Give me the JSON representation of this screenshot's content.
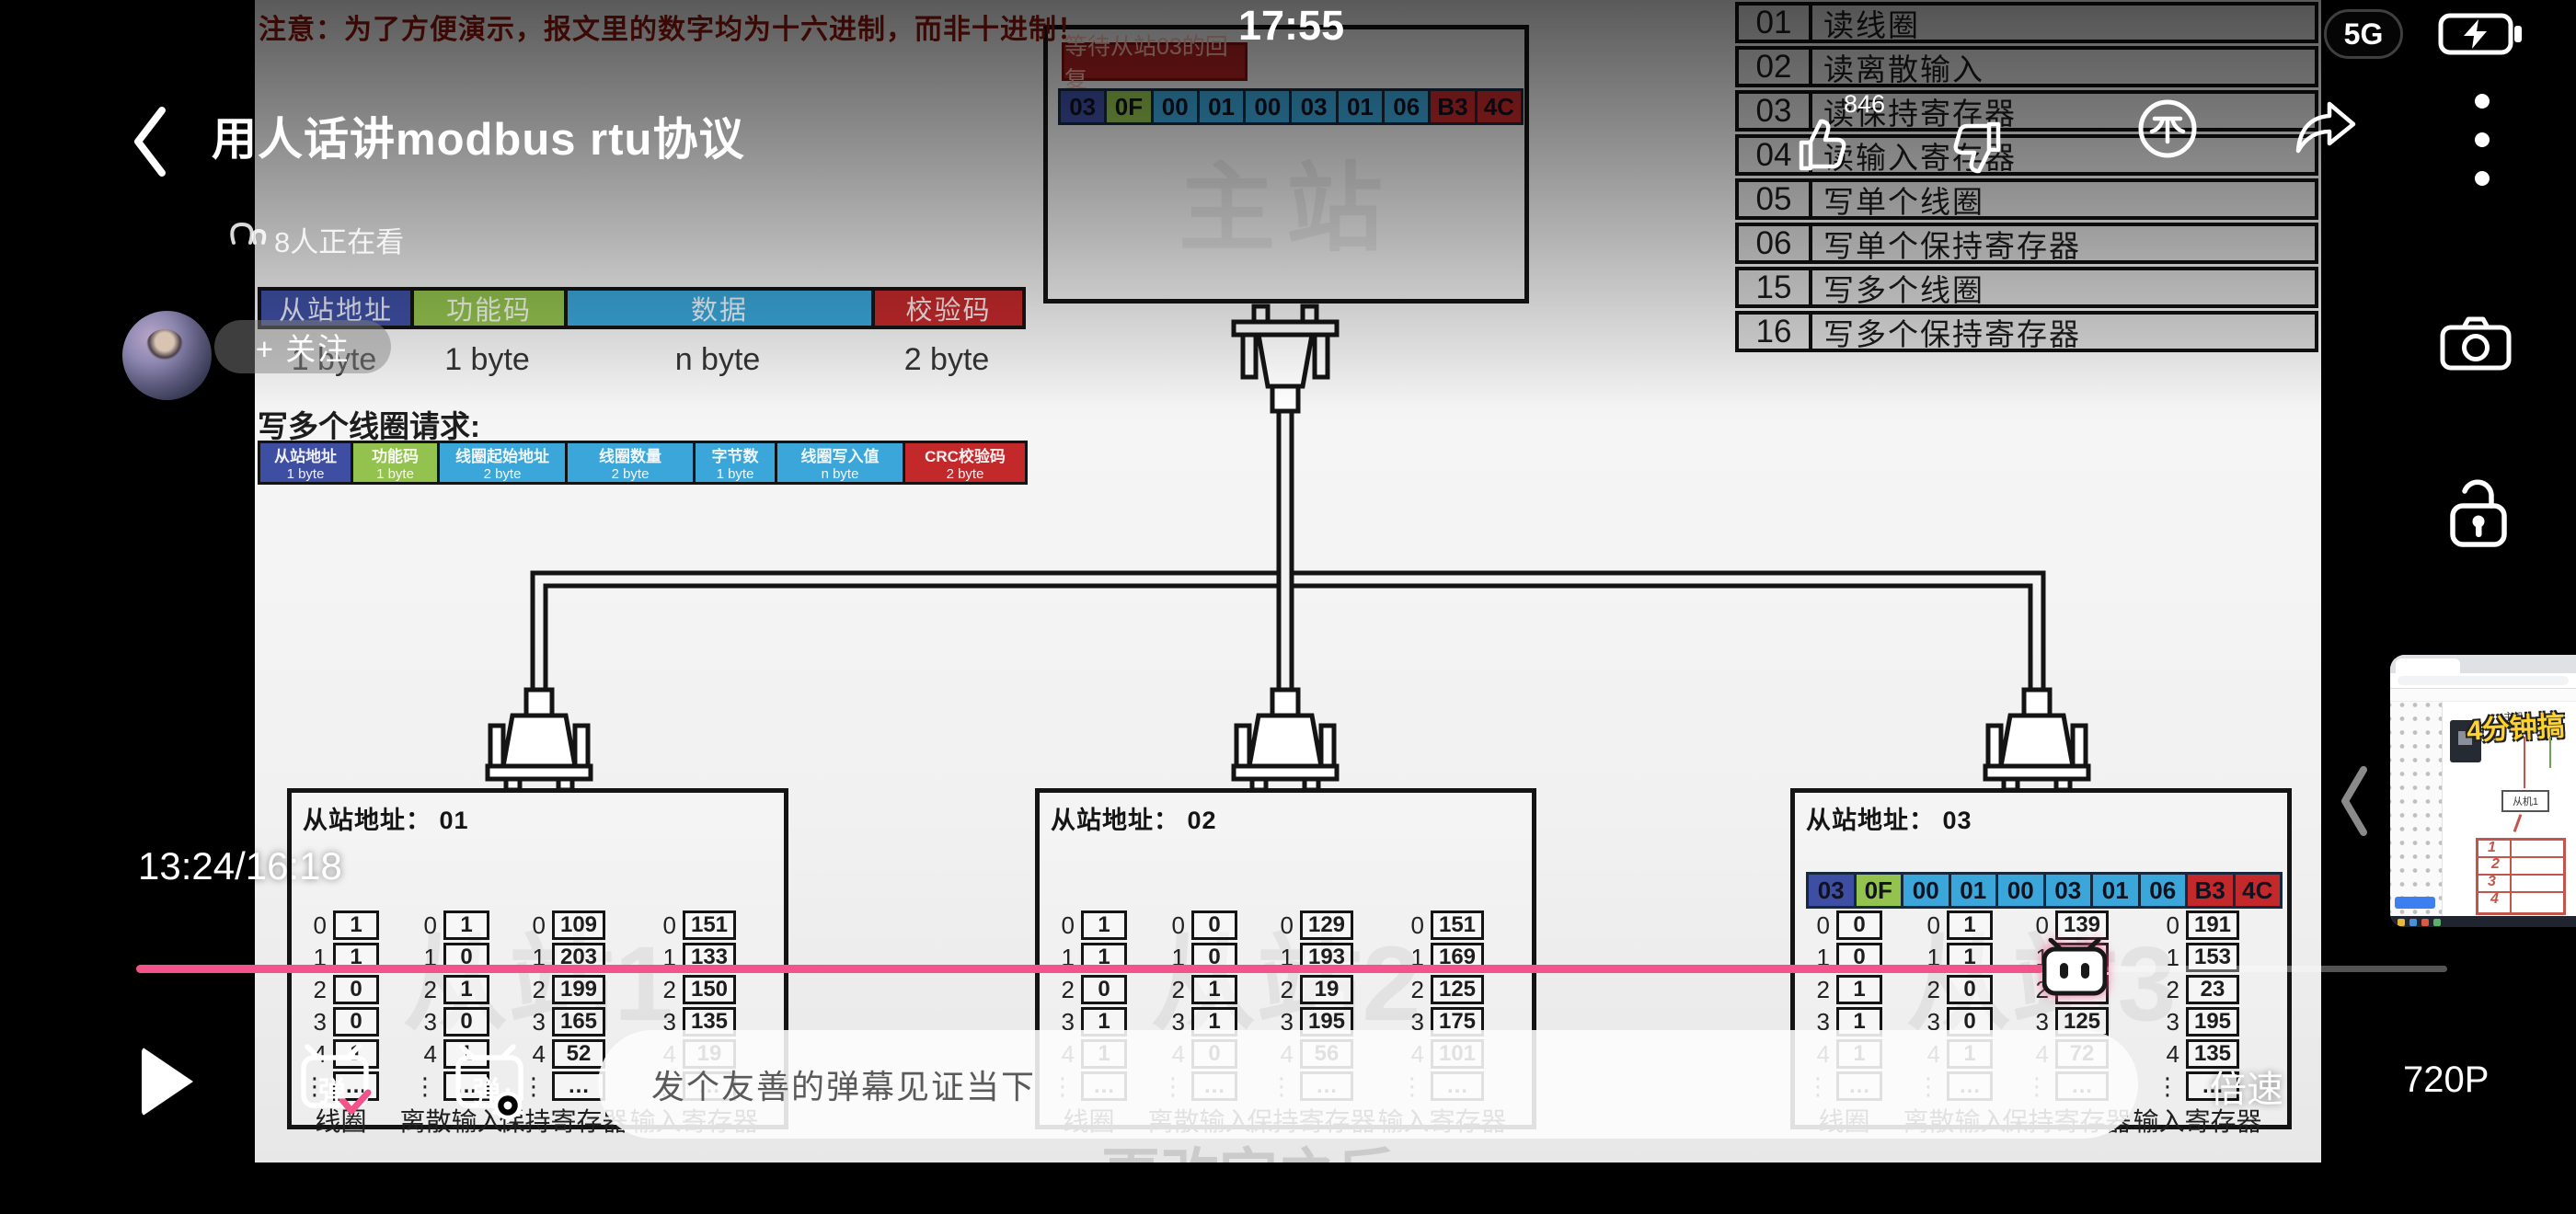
{
  "status_bar": {
    "time": "17:55",
    "network": "5G"
  },
  "player": {
    "title": "用人话讲modbus rtu协议",
    "viewers": "8人正在看",
    "follow_label": "+ 关注",
    "like_count": "846",
    "progress": {
      "display": "13:24/16:18",
      "current": "13:24",
      "duration": "16:18",
      "percent": 82
    },
    "danmaku_char": "弹",
    "danmaku_placeholder": "发个友善的弹幕见证当下",
    "speed_label": "倍速",
    "quality_label": "720P"
  },
  "colors": {
    "accent_pink": "#f2538b",
    "byte_address": "#3e4fa3",
    "byte_function": "#93c24e",
    "byte_data": "#3aa6d9",
    "byte_crc": "#c3292b",
    "warning_red": "#8a150c"
  },
  "video": {
    "warning": "注意：为了方便演示，报文里的数字均为十六进制，而非十进制！",
    "row_indices": [
      "0",
      "1",
      "2",
      "3",
      "4",
      "⋮"
    ],
    "master": {
      "watermark": "主站",
      "status_label": "等待从站03的回复",
      "message": [
        "03",
        "0F",
        "00",
        "01",
        "00",
        "03",
        "01",
        "06",
        "B3",
        "4C"
      ]
    },
    "frame_fields": [
      {
        "label": "从站地址",
        "size": "1 byte",
        "type": "addr"
      },
      {
        "label": "功能码",
        "size": "1 byte",
        "type": "func"
      },
      {
        "label": "数据",
        "size": "n byte",
        "type": "data"
      },
      {
        "label": "校验码",
        "size": "2 byte",
        "type": "crc"
      }
    ],
    "request_title": "写多个线圈请求:",
    "request_fields": [
      {
        "label": "从站地址",
        "size": "1 byte",
        "type": "addr"
      },
      {
        "label": "功能码",
        "size": "1 byte",
        "type": "func"
      },
      {
        "label": "线圈起始地址",
        "size": "2 byte",
        "type": "data"
      },
      {
        "label": "线圈数量",
        "size": "2 byte",
        "type": "data"
      },
      {
        "label": "字节数",
        "size": "1 byte",
        "type": "data"
      },
      {
        "label": "线圈写入值",
        "size": "n byte",
        "type": "data"
      },
      {
        "label": "CRC校验码",
        "size": "2 byte",
        "type": "crc"
      }
    ],
    "function_table": [
      {
        "code": "01",
        "name": "读线圈"
      },
      {
        "code": "02",
        "name": "读离散输入"
      },
      {
        "code": "03",
        "name": "读保持寄存器"
      },
      {
        "code": "04",
        "name": "读输入寄存器"
      },
      {
        "code": "05",
        "name": "写单个线圈"
      },
      {
        "code": "06",
        "name": "写单个保持寄存器"
      },
      {
        "code": "15",
        "name": "写多个线圈"
      },
      {
        "code": "16",
        "name": "写多个保持寄存器"
      }
    ],
    "slaves": [
      {
        "title": "从站地址： 01",
        "watermark": "从站1",
        "labels": [
          "线圈",
          "离散输入",
          "保持寄存器",
          "输入寄存器"
        ],
        "coils": [
          "1",
          "1",
          "0",
          "0",
          "1",
          "…"
        ],
        "discrete": [
          "1",
          "0",
          "1",
          "0",
          "1",
          "…"
        ],
        "holding": [
          "109",
          "203",
          "199",
          "165",
          "52",
          "…"
        ],
        "input": [
          "151",
          "133",
          "150",
          "135",
          "19",
          "…"
        ]
      },
      {
        "title": "从站地址： 02",
        "watermark": "从站2",
        "labels": [
          "线圈",
          "离散输入",
          "保持寄存器",
          "输入寄存器"
        ],
        "coils": [
          "1",
          "1",
          "0",
          "1",
          "1",
          "…"
        ],
        "discrete": [
          "0",
          "0",
          "1",
          "1",
          "0",
          "…"
        ],
        "holding": [
          "129",
          "193",
          "19",
          "195",
          "56",
          "…"
        ],
        "input": [
          "151",
          "169",
          "125",
          "175",
          "101",
          "…"
        ]
      },
      {
        "title": "从站地址： 03",
        "watermark": "从站3",
        "message": [
          "03",
          "0F",
          "00",
          "01",
          "00",
          "03",
          "01",
          "06",
          "B3",
          "4C"
        ],
        "labels": [
          "线圈",
          "离散输入",
          "保持寄存器",
          "输入寄存器"
        ],
        "coils": [
          "0",
          "0",
          "1",
          "1",
          "1",
          "…"
        ],
        "discrete": [
          "1",
          "1",
          "0",
          "0",
          "1",
          "…"
        ],
        "holding": [
          "139",
          "",
          "",
          "125",
          "72",
          "…"
        ],
        "input": [
          "191",
          "153",
          "23",
          "195",
          "135",
          "…"
        ]
      }
    ],
    "bottom_watermark": "更改完之后"
  },
  "pip": {
    "overlay_text": "4分钟搞",
    "top_label": "主机",
    "node_label": "从机1",
    "sketch_rows": [
      "1",
      "2",
      "3",
      "4"
    ]
  }
}
